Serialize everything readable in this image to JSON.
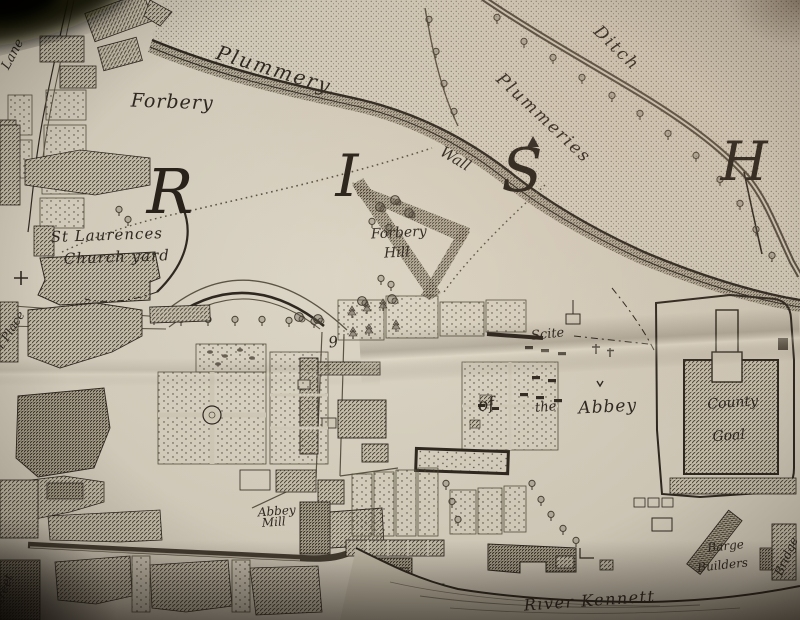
{
  "map": {
    "parish_letters": {
      "r": "R",
      "i": "I",
      "s": "S",
      "h": "H"
    },
    "labels": {
      "lane": "Lane",
      "plummery": "Plummery",
      "forbery": "Forbery",
      "ditch": "Ditch",
      "plummeries": "Plummeries",
      "wall": "Wall",
      "st_laurences": "St Laurences",
      "church_yard": "Church yard",
      "forbery_hill_1": "Forbery",
      "forbery_hill_2": "Hill",
      "scite": "Scite",
      "of": "of",
      "the": "the",
      "abbey": "Abbey",
      "county": "County",
      "goal": "Goal",
      "abbey_mill_1": "Abbey",
      "abbey_mill_2": "Mill",
      "barge": "Barge",
      "builders": "Builders",
      "river_kennett": "River Kennett",
      "plot_number": "9",
      "edge_left_place": "t Place",
      "edge_left_street": "treet",
      "edge_right_bridge": "Bridge"
    }
  },
  "colors": {
    "paper": "#d2cab9",
    "paper_light": "#ddd6c5",
    "ink": "#2e2820",
    "ink_faint": "#5c5445",
    "hatch_bg": "#c7bfac",
    "river": "#c8c0ad",
    "shadow": "#0b0806"
  }
}
